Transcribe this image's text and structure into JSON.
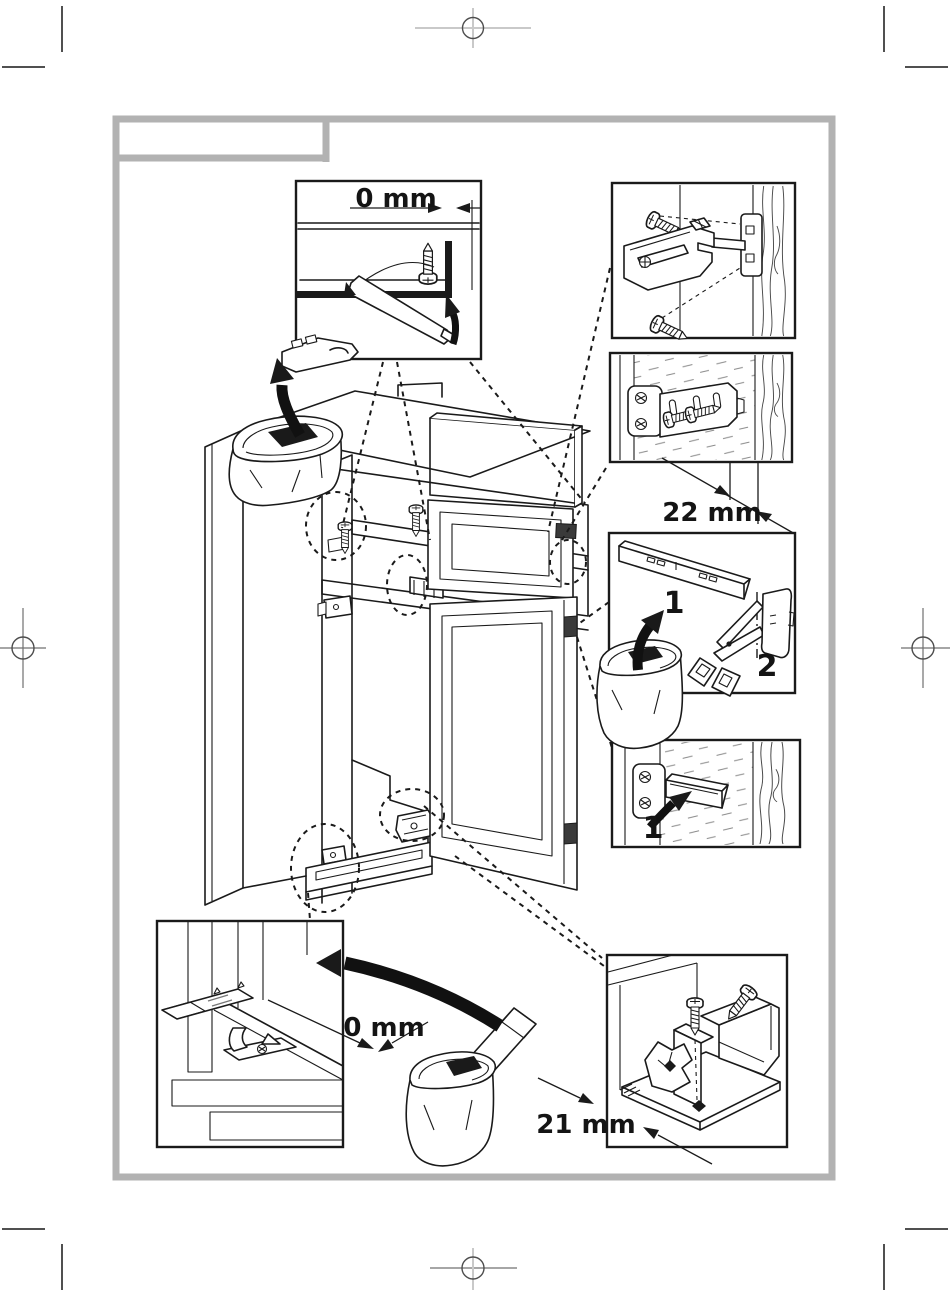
{
  "doc": {
    "kind": "refrigerator built-in installation diagram page",
    "colors": {
      "paper": "#ffffff",
      "ink": "#1a1a1a",
      "frame_gray": "#b2b2b2"
    },
    "labels": {
      "top_gap": "0 mm",
      "bracket_offset": "22 mm",
      "rail_part": "1",
      "cap_part": "2",
      "cover_part": "1",
      "bottom_gap": "0 mm",
      "base_offset": "21 mm"
    }
  }
}
